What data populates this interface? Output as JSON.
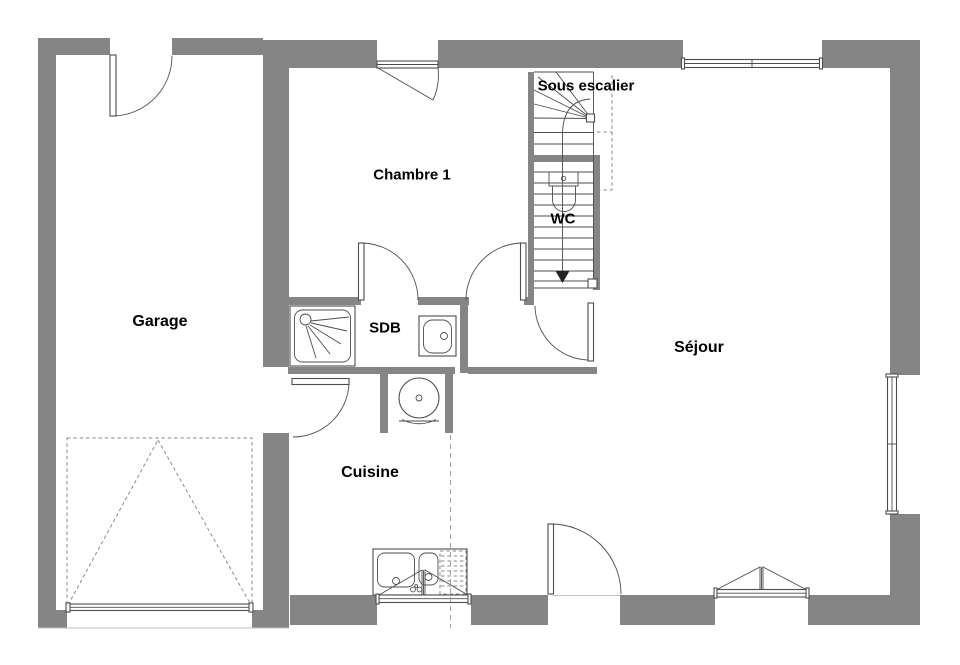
{
  "plan": {
    "rooms": {
      "garage": {
        "label": "Garage"
      },
      "chambre1": {
        "label": "Chambre 1"
      },
      "sous_escalier": {
        "label": "Sous escalier"
      },
      "wc": {
        "label": "WC"
      },
      "sdb": {
        "label": "SDB"
      },
      "cuisine": {
        "label": "Cuisine"
      },
      "sejour": {
        "label": "Séjour"
      }
    },
    "colors": {
      "wall": "#858585",
      "line": "#4d4d4d",
      "light_line": "#9e9e9e",
      "dash": "#8a8a8a",
      "label_text": "#000000",
      "background": "#ffffff"
    }
  }
}
